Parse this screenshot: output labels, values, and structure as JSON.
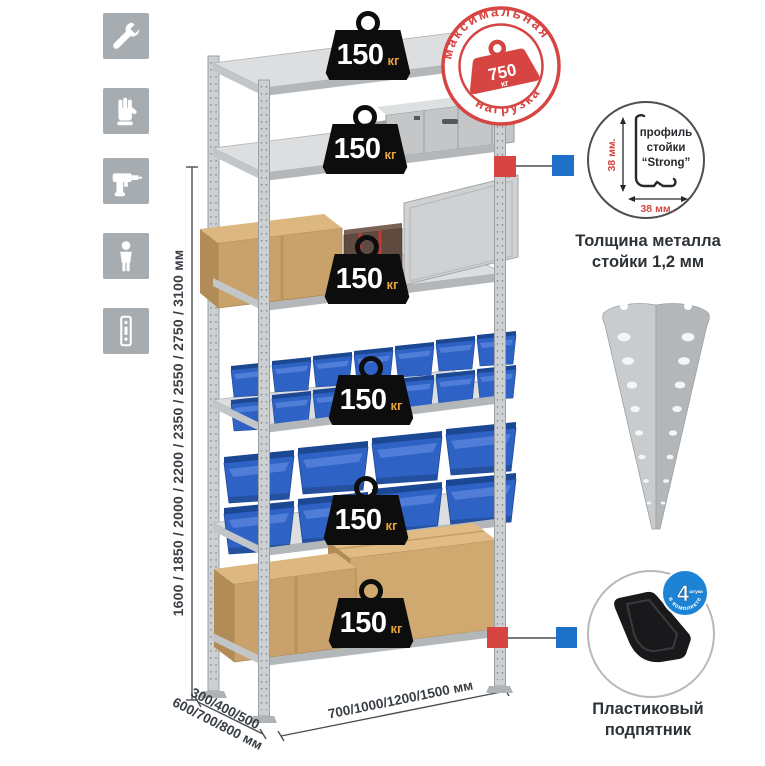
{
  "page": {
    "width": 765,
    "height": 765,
    "background": "#ffffff"
  },
  "colors": {
    "accent_red": "#d64541",
    "marker_blue": "#1d71c8",
    "foot_badge_blue": "#1d83d5",
    "bin_blue": "#2e62c4",
    "metal_gray": "#cdd0d2",
    "cardboard_tan": "#c9a26b",
    "badge_black": "#0d0d0e",
    "unit_orange": "#e8a33d",
    "icon_gray": "#a7acb1",
    "text_dark": "#2d3237"
  },
  "feature_icons": [
    {
      "name": "wrench"
    },
    {
      "name": "gloves"
    },
    {
      "name": "drill"
    },
    {
      "name": "person"
    },
    {
      "name": "rack-profile"
    }
  ],
  "dimensions": {
    "heights": "1600 / 1850 / 2000 / 2200 / 2350 / 2550 / 2750 / 3100 мм",
    "depth_line1": "300/400/500",
    "depth_line2": "600/700/800 мм",
    "width_label": "700/1000/1200/1500 мм"
  },
  "shelf_badges": [
    {
      "value": "150",
      "unit": "кг"
    },
    {
      "value": "150",
      "unit": "кг"
    },
    {
      "value": "150",
      "unit": "кг"
    },
    {
      "value": "150",
      "unit": "кг"
    },
    {
      "value": "150",
      "unit": "кг"
    },
    {
      "value": "150",
      "unit": "кг"
    }
  ],
  "max_load_stamp": {
    "arc_top": "максимальная",
    "arc_bottom": "нагрузка",
    "value": "750",
    "unit": "кг"
  },
  "profile_detail": {
    "line1": "профиль",
    "line2": "стойки",
    "line3": "“Strong”",
    "dim_vertical": "38 мм.",
    "dim_horizontal": "38 мм.",
    "caption_line1": "Толщина металла",
    "caption_line2": "стойки 1,2 мм"
  },
  "foot_detail": {
    "badge_value": "4",
    "badge_small": "штуки",
    "badge_arc": "в комплекте",
    "caption_line1": "Пластиковый",
    "caption_line2": "подпятник"
  }
}
